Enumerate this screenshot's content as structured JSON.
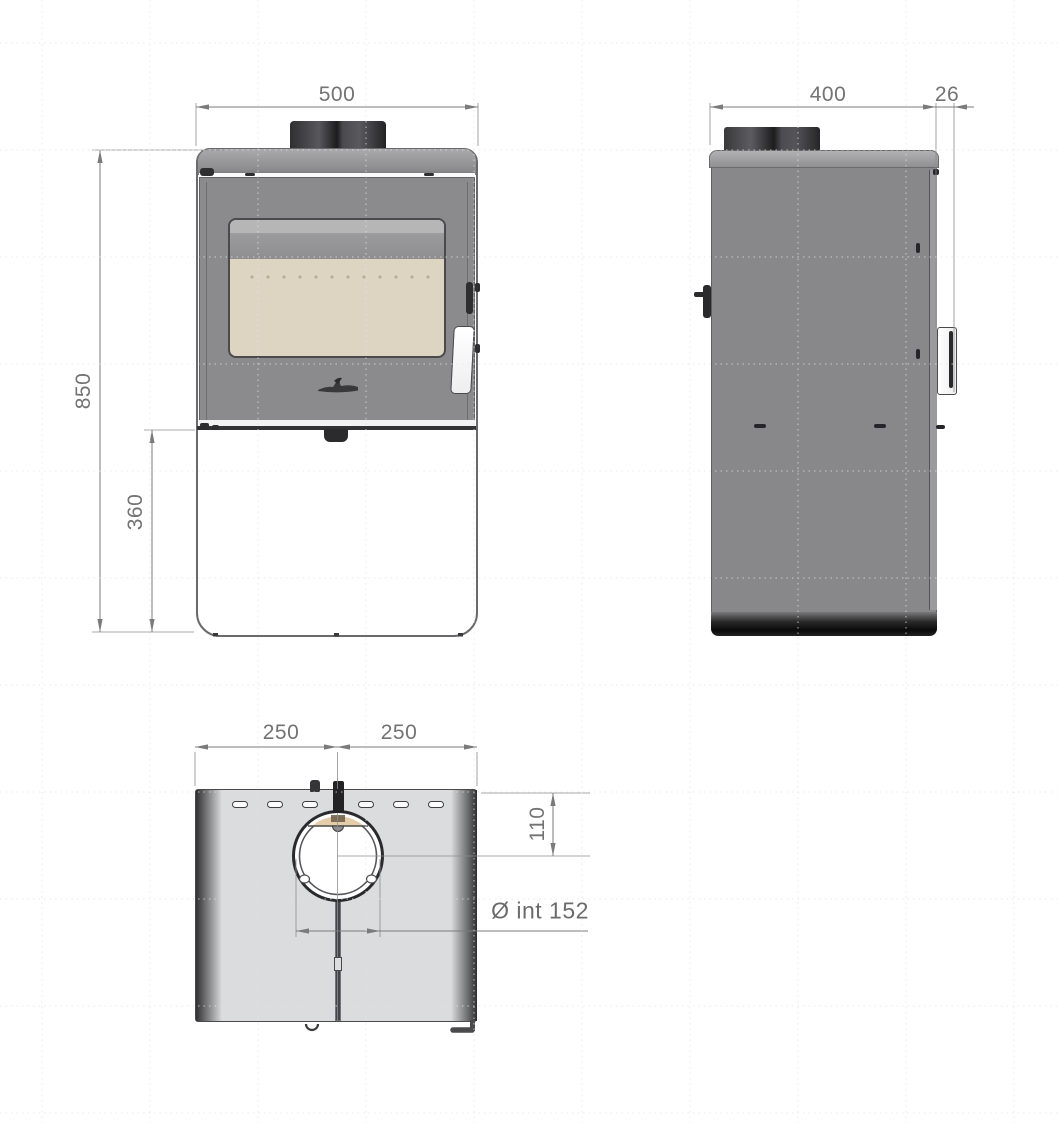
{
  "drawing": {
    "title": "stove dimensional drawing",
    "front_view": {
      "overall_width_mm": "500",
      "overall_height_mm": "850",
      "lower_body_height_mm": "360"
    },
    "side_view": {
      "body_depth_mm": "400",
      "door_protrusion_mm": "26"
    },
    "top_view": {
      "flue_center_from_left_mm": "250",
      "flue_center_from_right_mm": "250",
      "flue_center_from_back_mm": "110",
      "flue_inner_diameter_label": "Ø int 152"
    }
  },
  "palette": {
    "body_gray": "#8b8b8d",
    "top_plate_gray": "#a9a9ab",
    "glass_beige": "#ddd5c2",
    "flue_dark": "#232325",
    "top_view_fill": "#dbdcdd",
    "dimension_line_gray": "#7b7b7b",
    "dimension_text_gray": "#737373"
  }
}
